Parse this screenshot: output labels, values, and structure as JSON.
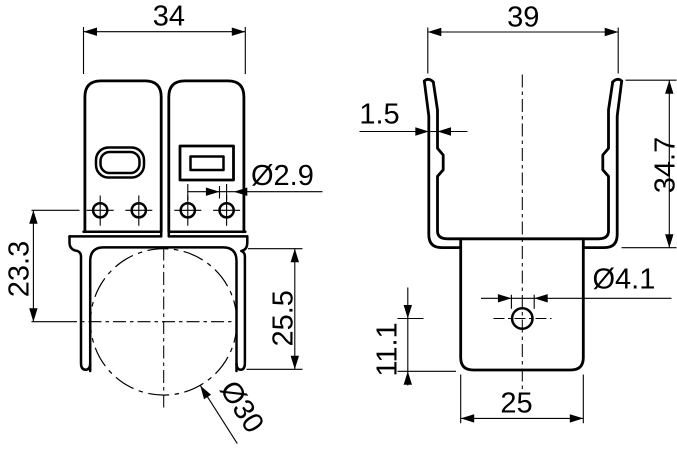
{
  "page": {
    "background": "#ffffff",
    "ink": "#000000",
    "kind": "technical-drawing-2-views-pipe-clamp"
  },
  "views": {
    "front": {
      "dims": {
        "overall_width": "34",
        "hole_dia": "Ø2.9",
        "center_offset": "23.3",
        "leg_depth": "25.5",
        "tube_dia": "Ø30"
      }
    },
    "side": {
      "dims": {
        "overall_width": "39",
        "sheet_thickness": "1.5",
        "overall_height": "34.7",
        "hole_dia": "Ø4.1",
        "hole_height": "11.1",
        "tab_width": "25"
      }
    }
  }
}
